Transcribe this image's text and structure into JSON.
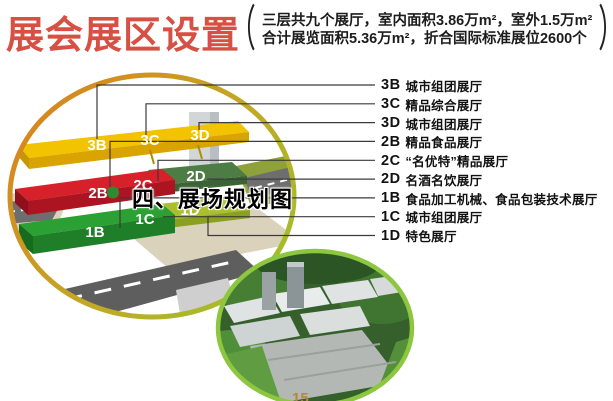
{
  "header": {
    "title": "展会展区设置",
    "paren_open": "（",
    "paren_close": "）",
    "note_line1": "三层共九个展厅，室内面积3.86万m²，室外1.5万m²",
    "note_line2": "合计展览面积5.36万m²，折合国际标准展位2600个"
  },
  "overlay_title": "四、展场规划图",
  "diagram": {
    "labels": {
      "3b": "3B",
      "3c": "3C",
      "3d": "3D",
      "2b": "2B",
      "2c": "2C",
      "2d": "2D",
      "1b": "1B",
      "1c": "1C",
      "1d": "1D"
    }
  },
  "legend": {
    "items": [
      {
        "code": "3B",
        "label": "城市组团展厅"
      },
      {
        "code": "3C",
        "label": "精品综合展厅"
      },
      {
        "code": "3D",
        "label": "城市组团展厅"
      },
      {
        "code": "2B",
        "label": "精品食品展厅"
      },
      {
        "code": "2C",
        "label": "“名优特”精品展厅"
      },
      {
        "code": "2D",
        "label": "名酒名饮展厅"
      },
      {
        "code": "1B",
        "label": "食品加工机械、食品包装技术展厅"
      },
      {
        "code": "1C",
        "label": "城市组团展厅"
      },
      {
        "code": "1D",
        "label": "特色展厅"
      }
    ]
  },
  "page_number": "15",
  "colors": {
    "title_red": "#d85043",
    "ring_orange": "#d9831f",
    "ring_green": "#9fc02c",
    "floor3_yellow": "#f2c300",
    "floor2_red": "#d6202a",
    "floor1_green": "#2ba133",
    "hall_d_dark_green": "#4d7c44",
    "hall_d_yellow_green": "#a9bf2b",
    "road_gray": "#5e5e5e",
    "ground_tan": "#dbd2bb",
    "photo_ring_green": "#8dc63f",
    "leader_line": "#3b3b3b"
  }
}
